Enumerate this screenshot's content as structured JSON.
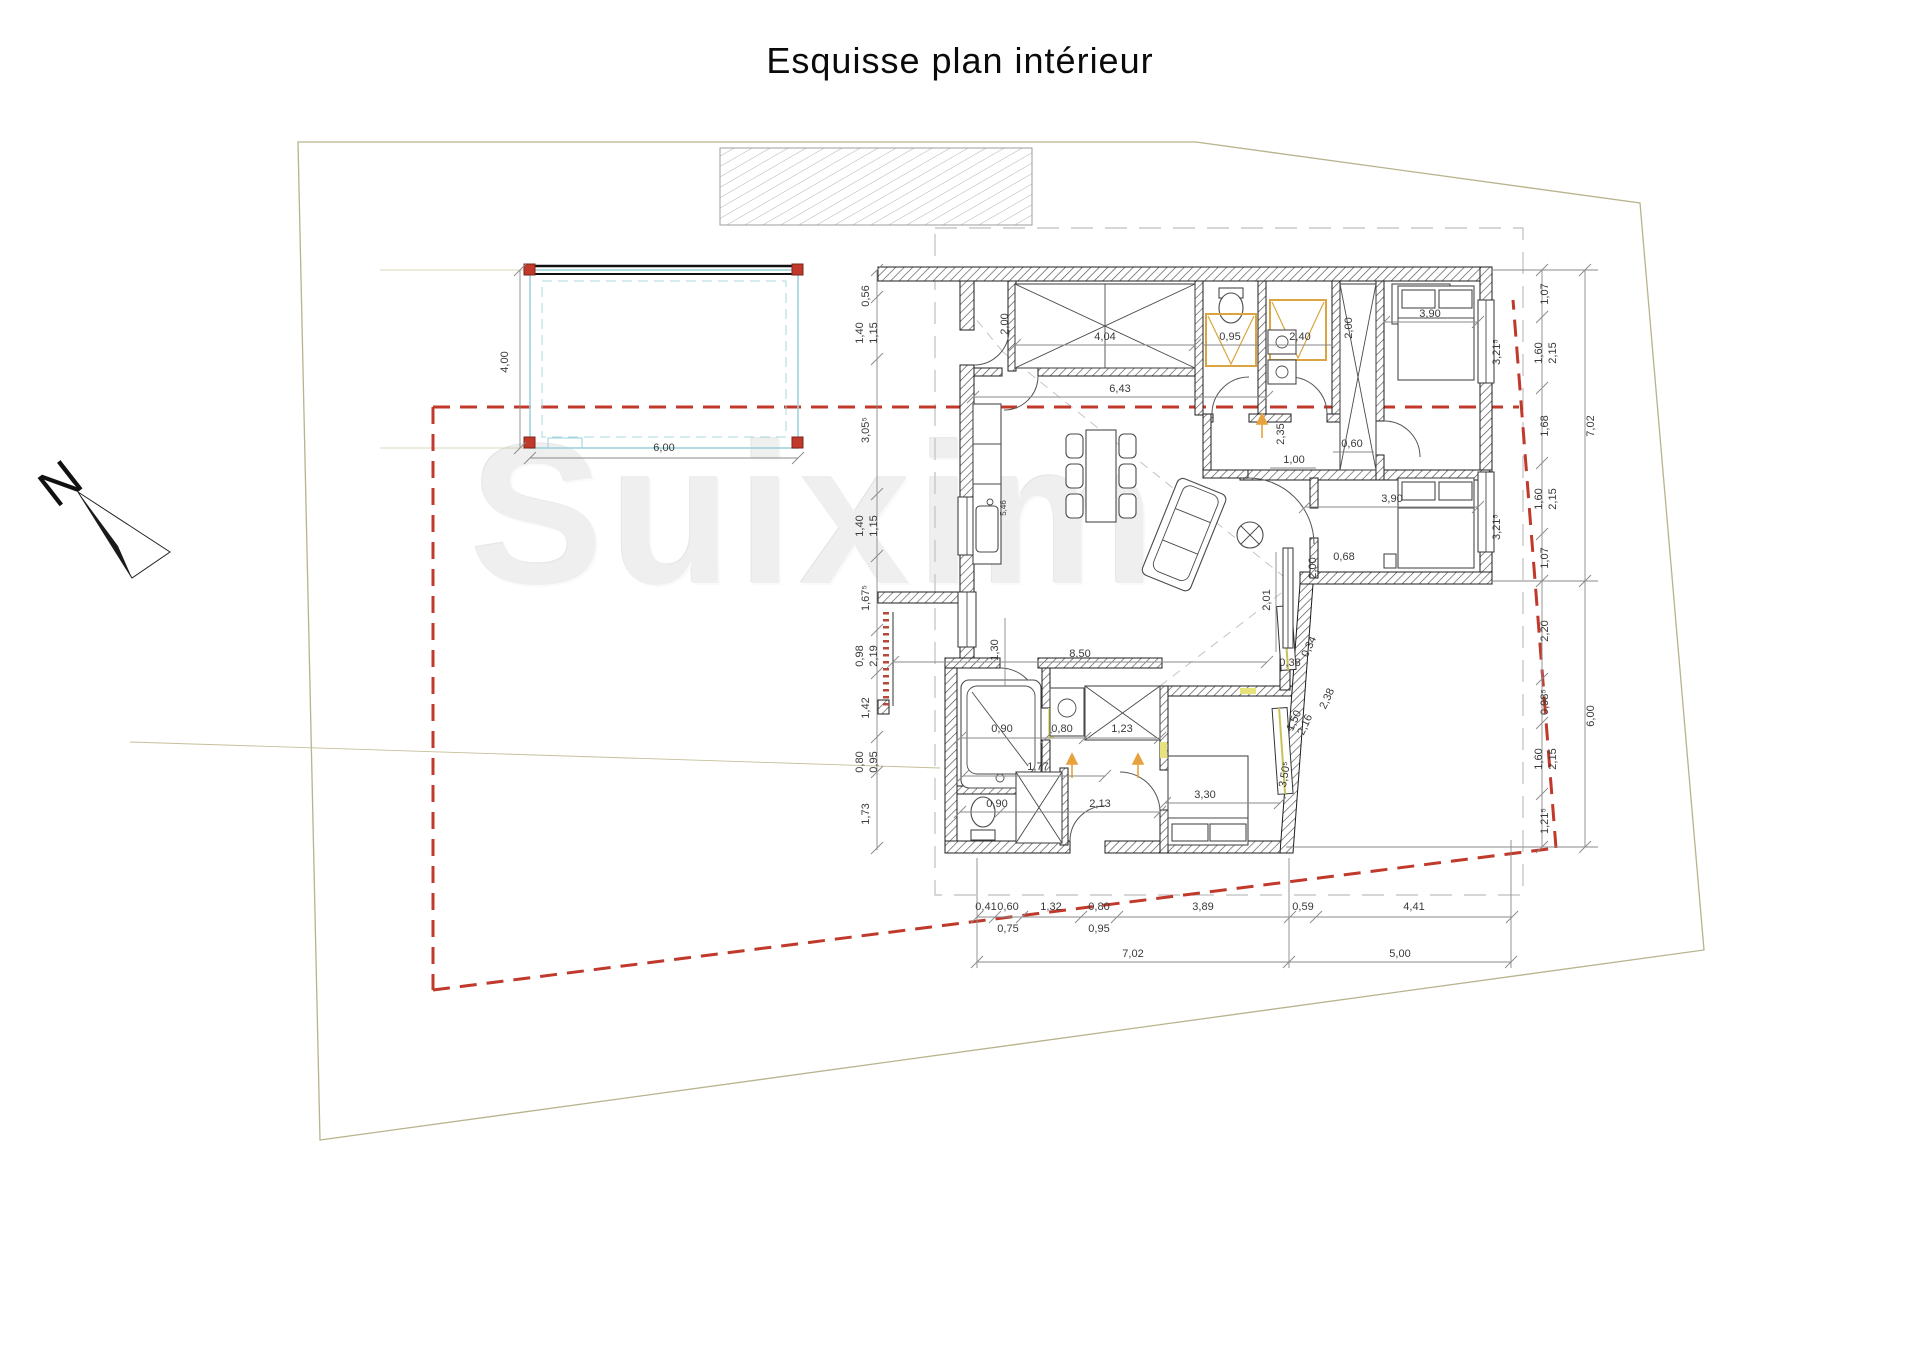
{
  "title": "Esquisse plan intérieur",
  "watermark": "Suixim",
  "north_label": "N",
  "colors": {
    "property_line_red": "#c0392b",
    "carport_cyan": "#9ed3dd",
    "post_red": "#c0392b",
    "fixture_orange": "#d9a441",
    "accent_yellow": "#e8e27a",
    "parcel_beige": "#b8b38c",
    "roof_dash_gray": "#c8c8c8"
  },
  "plan": {
    "dimensions": [
      {
        "t": "0,56",
        "x": 869,
        "y": 296,
        "r": -90
      },
      {
        "t": "1,40",
        "x": 863,
        "y": 333,
        "r": -90
      },
      {
        "t": "1,15",
        "x": 877,
        "y": 333,
        "r": -90
      },
      {
        "t": "3,05⁵",
        "x": 869,
        "y": 430,
        "r": -90
      },
      {
        "t": "1,40",
        "x": 863,
        "y": 526,
        "r": -90
      },
      {
        "t": "1,15",
        "x": 877,
        "y": 526,
        "r": -90
      },
      {
        "t": "1,67⁵",
        "x": 869,
        "y": 598,
        "r": -90
      },
      {
        "t": "0,98",
        "x": 863,
        "y": 656,
        "r": -90
      },
      {
        "t": "2,19",
        "x": 877,
        "y": 656,
        "r": -90
      },
      {
        "t": "1,42",
        "x": 869,
        "y": 708,
        "r": -90
      },
      {
        "t": "0,80",
        "x": 863,
        "y": 762,
        "r": -90
      },
      {
        "t": "0,95",
        "x": 877,
        "y": 762,
        "r": -90
      },
      {
        "t": "1,73",
        "x": 869,
        "y": 814,
        "r": -90
      },
      {
        "t": "4,00",
        "x": 508,
        "y": 362,
        "r": -90
      },
      {
        "t": "6,00",
        "x": 664,
        "y": 451,
        "r": 0
      },
      {
        "t": "2,00",
        "x": 1008,
        "y": 324,
        "r": -90
      },
      {
        "t": "4,04",
        "x": 1105,
        "y": 340,
        "r": 0
      },
      {
        "t": "0,95",
        "x": 1230,
        "y": 340,
        "r": 0
      },
      {
        "t": "2,40",
        "x": 1300,
        "y": 340,
        "r": 0
      },
      {
        "t": "2,00",
        "x": 1352,
        "y": 328,
        "r": -90
      },
      {
        "t": "3,90",
        "x": 1430,
        "y": 317,
        "r": 0
      },
      {
        "t": "3,21⁵",
        "x": 1500,
        "y": 352,
        "r": -90
      },
      {
        "t": "6,43",
        "x": 1120,
        "y": 392,
        "r": 0
      },
      {
        "t": "0,60",
        "x": 1352,
        "y": 447,
        "r": 0
      },
      {
        "t": "2,35",
        "x": 1284,
        "y": 434,
        "r": -90
      },
      {
        "t": "1,00",
        "x": 1294,
        "y": 463,
        "r": 0
      },
      {
        "t": "3,90",
        "x": 1392,
        "y": 502,
        "r": 0
      },
      {
        "t": "3,21⁵",
        "x": 1500,
        "y": 527,
        "r": -90
      },
      {
        "t": "2,00",
        "x": 1316,
        "y": 568,
        "r": -90
      },
      {
        "t": "0,68",
        "x": 1344,
        "y": 560,
        "r": 0
      },
      {
        "t": "2,01",
        "x": 1270,
        "y": 600,
        "r": -90
      },
      {
        "t": "0,38",
        "x": 1290,
        "y": 666,
        "r": 0
      },
      {
        "t": "0,34",
        "x": 1312,
        "y": 648,
        "r": -65
      },
      {
        "t": "2,38",
        "x": 1330,
        "y": 700,
        "r": -65
      },
      {
        "t": "1,50",
        "x": 1297,
        "y": 722,
        "r": -65
      },
      {
        "t": "2,16",
        "x": 1308,
        "y": 726,
        "r": -65
      },
      {
        "t": "3,50⁵",
        "x": 1288,
        "y": 775,
        "r": -80
      },
      {
        "t": "8,50",
        "x": 1080,
        "y": 657,
        "r": 0
      },
      {
        "t": "1,30",
        "x": 998,
        "y": 650,
        "r": -90
      },
      {
        "t": "5,46",
        "x": 1006,
        "y": 508,
        "r": -90,
        "s": 1
      },
      {
        "t": "0,90",
        "x": 1002,
        "y": 732,
        "r": 0
      },
      {
        "t": "0,80",
        "x": 1062,
        "y": 732,
        "r": 0
      },
      {
        "t": "1,23",
        "x": 1122,
        "y": 732,
        "r": 0
      },
      {
        "t": "1,77",
        "x": 1038,
        "y": 770,
        "r": 0
      },
      {
        "t": "0,90",
        "x": 997,
        "y": 807,
        "r": 0
      },
      {
        "t": "2,13",
        "x": 1100,
        "y": 807,
        "r": 0
      },
      {
        "t": "3,30",
        "x": 1205,
        "y": 798,
        "r": 0
      },
      {
        "t": "0,41",
        "x": 986,
        "y": 910,
        "r": 0
      },
      {
        "t": "0,60",
        "x": 1008,
        "y": 910,
        "r": 0
      },
      {
        "t": "1,32",
        "x": 1051,
        "y": 910,
        "r": 0
      },
      {
        "t": "0,80",
        "x": 1099,
        "y": 910,
        "r": 0
      },
      {
        "t": "3,89",
        "x": 1203,
        "y": 910,
        "r": 0
      },
      {
        "t": "0,59",
        "x": 1303,
        "y": 910,
        "r": 0
      },
      {
        "t": "4,41",
        "x": 1414,
        "y": 910,
        "r": 0
      },
      {
        "t": "0,75",
        "x": 1008,
        "y": 932,
        "r": 0
      },
      {
        "t": "0,95",
        "x": 1099,
        "y": 932,
        "r": 0
      },
      {
        "t": "7,02",
        "x": 1133,
        "y": 957,
        "r": 0
      },
      {
        "t": "5,00",
        "x": 1400,
        "y": 957,
        "r": 0
      },
      {
        "t": "1,07",
        "x": 1548,
        "y": 294,
        "r": -90
      },
      {
        "t": "1,60",
        "x": 1542,
        "y": 353,
        "r": -90
      },
      {
        "t": "2,15",
        "x": 1556,
        "y": 353,
        "r": -90
      },
      {
        "t": "1,68",
        "x": 1548,
        "y": 426,
        "r": -90
      },
      {
        "t": "1,60",
        "x": 1542,
        "y": 499,
        "r": -90
      },
      {
        "t": "2,15",
        "x": 1556,
        "y": 499,
        "r": -90
      },
      {
        "t": "1,07",
        "x": 1548,
        "y": 558,
        "r": -90
      },
      {
        "t": "7,02",
        "x": 1594,
        "y": 426,
        "r": -90
      },
      {
        "t": "2,20",
        "x": 1548,
        "y": 631,
        "r": -90
      },
      {
        "t": "0,98⁵",
        "x": 1548,
        "y": 702,
        "r": -90
      },
      {
        "t": "1,60",
        "x": 1542,
        "y": 759,
        "r": -90
      },
      {
        "t": "2,15",
        "x": 1556,
        "y": 759,
        "r": -90
      },
      {
        "t": "1,21⁵",
        "x": 1548,
        "y": 821,
        "r": -90
      },
      {
        "t": "6,00",
        "x": 1594,
        "y": 716,
        "r": -90
      }
    ]
  }
}
